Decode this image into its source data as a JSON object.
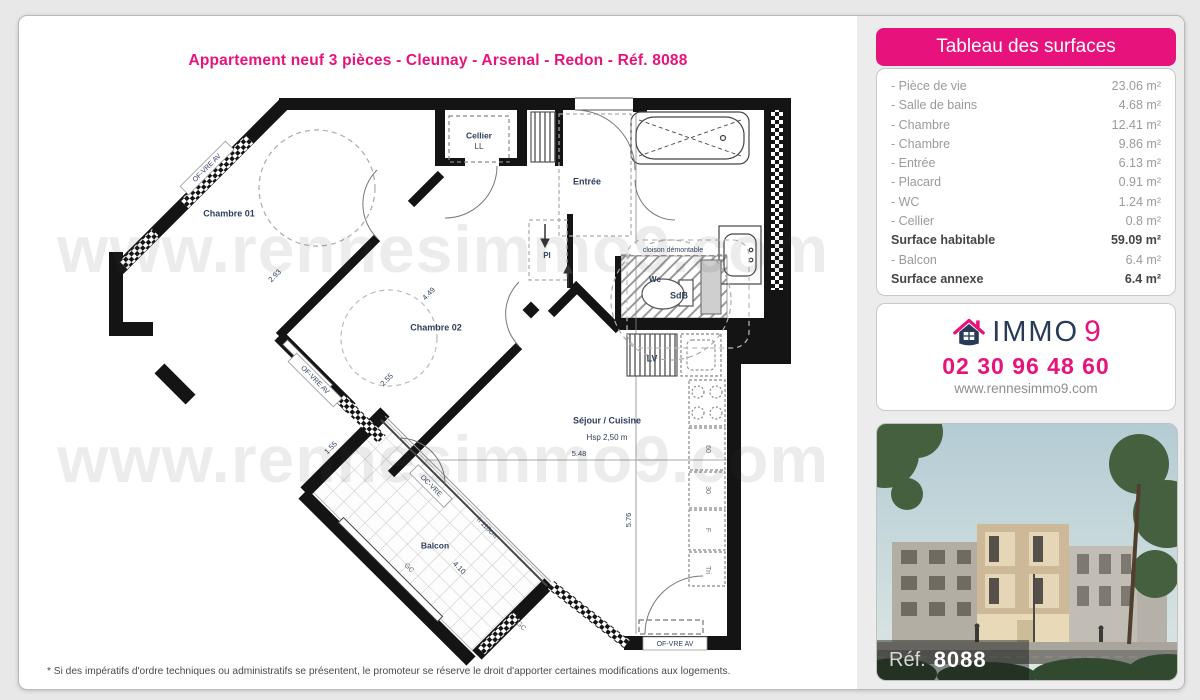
{
  "page": {
    "title": "Appartement neuf 3 pièces - Cleunay - Arsenal - Redon - Réf. 8088",
    "watermark": "www.rennesimmo9.com",
    "footnote": "* Si des impératifs d'ordre techniques ou administratifs se présentent, le promoteur se réserve le droit d'apporter certaines modifications aux logements."
  },
  "surfaces_panel": {
    "header": "Tableau des surfaces",
    "rows": [
      {
        "label": "- Pièce de vie",
        "value": "23.06 m²",
        "bold": false
      },
      {
        "label": "- Salle de bains",
        "value": "4.68 m²",
        "bold": false
      },
      {
        "label": "- Chambre",
        "value": "12.41 m²",
        "bold": false
      },
      {
        "label": "- Chambre",
        "value": "9.86 m²",
        "bold": false
      },
      {
        "label": "- Entrée",
        "value": "6.13 m²",
        "bold": false
      },
      {
        "label": "- Placard",
        "value": "0.91 m²",
        "bold": false
      },
      {
        "label": "- WC",
        "value": "1.24 m²",
        "bold": false
      },
      {
        "label": "- Cellier",
        "value": "0.8 m²",
        "bold": false
      },
      {
        "label": "Surface habitable",
        "value": "59.09 m²",
        "bold": true
      },
      {
        "label": "- Balcon",
        "value": "6.4 m²",
        "bold": false
      },
      {
        "label": "Surface annexe",
        "value": "6.4 m²",
        "bold": true
      }
    ]
  },
  "agency": {
    "brand": "IMMO",
    "brand_number": "9",
    "phone": "02 30 96 48 60",
    "website": "www.rennesimmo9.com",
    "brand_color": "#273a57",
    "accent_color": "#e8127c"
  },
  "photo": {
    "ref_label": "Réf.",
    "ref_number": "8088"
  },
  "floorplan": {
    "labels": [
      {
        "name": "room-label-chambre-01",
        "text": "Chambre 01",
        "x": 150,
        "y": 126,
        "rot": 0,
        "size": 9,
        "bold": true
      },
      {
        "name": "room-label-chambre-02",
        "text": "Chambre 02",
        "x": 357,
        "y": 240,
        "rot": 0,
        "size": 9,
        "bold": true
      },
      {
        "name": "room-label-entree",
        "text": "Entrée",
        "x": 508,
        "y": 94,
        "rot": 0,
        "size": 9,
        "bold": true
      },
      {
        "name": "room-label-sdb",
        "text": "SdB",
        "x": 600,
        "y": 208,
        "rot": 0,
        "size": 9,
        "bold": true
      },
      {
        "name": "room-label-wc",
        "text": "Wc",
        "x": 576,
        "y": 192,
        "rot": 0,
        "size": 8,
        "bold": true
      },
      {
        "name": "room-label-pl",
        "text": "Pl",
        "x": 468,
        "y": 168,
        "rot": 0,
        "size": 8,
        "bold": true
      },
      {
        "name": "room-label-cellier",
        "text": "Cellier",
        "x": 400,
        "y": 48,
        "rot": 0,
        "size": 8.5,
        "bold": true
      },
      {
        "name": "room-label-cellier-ll",
        "text": "LL",
        "x": 400,
        "y": 59,
        "rot": 0,
        "size": 8,
        "bold": false
      },
      {
        "name": "room-label-sejour",
        "text": "Séjour / Cuisine",
        "x": 528,
        "y": 333,
        "rot": 0,
        "size": 9,
        "bold": true
      },
      {
        "name": "label-hauteur-plafond",
        "text": "Hsp 2,50 m",
        "x": 528,
        "y": 350,
        "rot": 0,
        "size": 8,
        "bold": false
      },
      {
        "name": "room-label-balcon",
        "text": "Balcon",
        "x": 356,
        "y": 458,
        "rot": 0,
        "size": 8.5,
        "bold": true
      },
      {
        "name": "fixture-label-lv",
        "text": "LV",
        "x": 573,
        "y": 271,
        "rot": 0,
        "size": 9,
        "bold": true
      },
      {
        "name": "label-cloison-demontable",
        "text": "cloison démontable",
        "x": 594,
        "y": 162,
        "rot": 0,
        "size": 7,
        "bold": false
      },
      {
        "name": "label-gc-1",
        "text": "GC",
        "x": 330,
        "y": 480,
        "rot": 45,
        "size": 7,
        "bold": false,
        "color": "gray"
      },
      {
        "name": "label-gc-2",
        "text": "GC",
        "x": 442,
        "y": 538,
        "rot": 45,
        "size": 7,
        "bold": false,
        "color": "gray"
      },
      {
        "name": "window-label-of-vre-av-1",
        "text": "OF-VRE  AV",
        "x": 128,
        "y": 80,
        "rot": -45,
        "size": 7,
        "bold": false
      },
      {
        "name": "window-label-of-vre-av-2",
        "text": "OF-VRE  AV",
        "x": 236,
        "y": 292,
        "rot": 45,
        "size": 7,
        "bold": false
      },
      {
        "name": "window-label-of-vre-av-3",
        "text": "OF-VRE  AV",
        "x": 596,
        "y": 556,
        "rot": 0,
        "size": 7,
        "bold": false
      },
      {
        "name": "window-label-oc-vre",
        "text": "OC-VRE",
        "x": 352,
        "y": 398,
        "rot": 45,
        "size": 7,
        "bold": false
      },
      {
        "name": "dim-2-93",
        "text": "2.93",
        "x": 196,
        "y": 188,
        "rot": -45,
        "size": 7.5,
        "bold": false
      },
      {
        "name": "dim-4-49",
        "text": "4.49",
        "x": 350,
        "y": 206,
        "rot": -45,
        "size": 7.5,
        "bold": false
      },
      {
        "name": "dim-2-55",
        "text": "2.55",
        "x": 308,
        "y": 292,
        "rot": -45,
        "size": 7.5,
        "bold": false
      },
      {
        "name": "dim-5-48",
        "text": "5.48",
        "x": 500,
        "y": 366,
        "rot": 0,
        "size": 7.5,
        "bold": false
      },
      {
        "name": "dim-5-76",
        "text": "5.76",
        "x": 550,
        "y": 432,
        "rot": -90,
        "size": 7.5,
        "bold": false
      },
      {
        "name": "dim-1-55",
        "text": "1.55",
        "x": 252,
        "y": 360,
        "rot": -45,
        "size": 7.5,
        "bold": false
      },
      {
        "name": "dim-4-10",
        "text": "4.10",
        "x": 380,
        "y": 480,
        "rot": 45,
        "size": 7.5,
        "bold": false
      },
      {
        "name": "dim-garde-corps",
        "text": "h 110cm",
        "x": 408,
        "y": 440,
        "rot": 45,
        "size": 7,
        "bold": false
      },
      {
        "name": "kitchen-label-60",
        "text": "60",
        "x": 629,
        "y": 361,
        "rot": 90,
        "size": 7,
        "bold": false,
        "color": "gray"
      },
      {
        "name": "kitchen-label-30",
        "text": "30",
        "x": 629,
        "y": 402,
        "rot": 90,
        "size": 7,
        "bold": false,
        "color": "gray"
      },
      {
        "name": "kitchen-label-f",
        "text": "F",
        "x": 629,
        "y": 442,
        "rot": 90,
        "size": 7,
        "bold": false,
        "color": "gray"
      },
      {
        "name": "kitchen-label-tri",
        "text": "Tri",
        "x": 629,
        "y": 482,
        "rot": 90,
        "size": 7,
        "bold": false,
        "color": "gray"
      }
    ]
  }
}
